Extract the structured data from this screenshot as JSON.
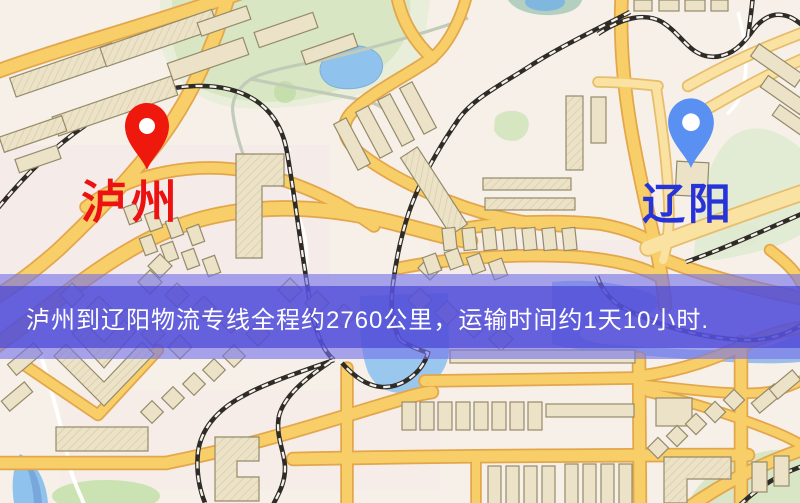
{
  "banner": {
    "text": "泸州到辽阳物流专线全程约2760公里，运输时间约1天10小时.",
    "overlay_color": "#7472e9",
    "strip_color": "#4c46d6",
    "text_color": "#ffffff"
  },
  "markers": {
    "origin": {
      "label": "泸州",
      "color": "#ec1212",
      "pin_color": "#ee180c"
    },
    "destination": {
      "label": "辽阳",
      "color": "#2633d9",
      "pin_color": "#5a90f2"
    }
  },
  "map": {
    "palette": {
      "background": "#f6f0e9",
      "road_fill": "#f7ce68",
      "road_casing": "#e3a64b",
      "road_minor": "#fae3a2",
      "road_minor_casing": "#e7bc6b",
      "building": "#ece2c8",
      "building_outline": "#958b69",
      "park": "#d8e6c3",
      "water": "#92c5ee",
      "railway": "#2f2c28"
    }
  }
}
